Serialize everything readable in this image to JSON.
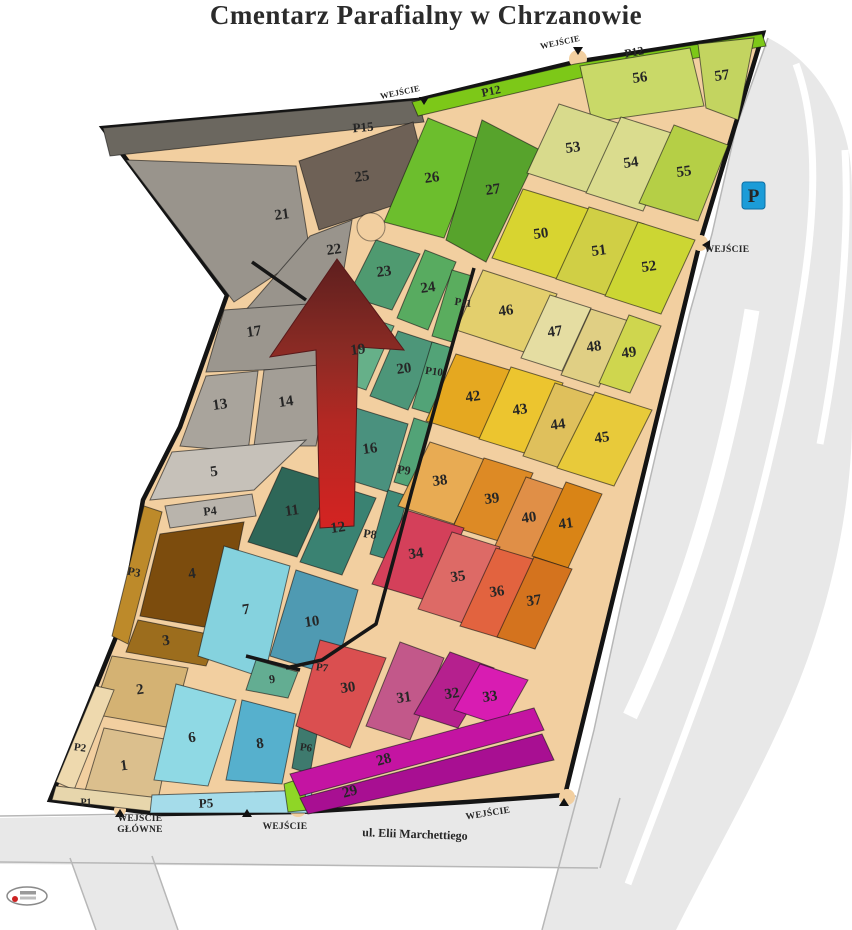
{
  "title": "Cmentarz Parafialny w Chrzanowie",
  "map": {
    "base_fill": "#f2cfa0",
    "outline_stroke": "#141414",
    "outline": "103,128 418,100 575,62 763,33 700,242 565,795 467,802 300,812 160,814 50,800 120,627 143,500 180,427 227,295",
    "roads": {
      "fill": "#e8e8e8",
      "edge": "#b7b7b7",
      "fills": [
        "M768,38 C802,54 830,88 842,126 C851,152 852,172 852,200 L852,418 C852,520 824,632 780,726 C748,796 708,866 676,930 L542,930 L560,862 L578,794 L594,730 L622,600 L660,436 L690,312 L712,234 L736,128 Z",
        "M0,818 L300,812 L467,802 L576,796 L620,798 L600,868 L0,864 Z",
        "M70,858 L152,856 L178,930 L96,930 Z"
      ],
      "stripes": [
        {
          "d": "M796,64 C820,130 816,220 798,320 C778,436 746,564 706,676 C684,738 658,804 628,884",
          "w": 7
        },
        {
          "d": "M845,150 C850,240 840,340 820,444",
          "w": 7
        },
        {
          "d": "M752,310 C736,406 714,498 684,584 C668,630 650,674 630,716",
          "w": 15
        }
      ],
      "edges": [
        "M0,816 L300,812 L467,802 L576,796",
        "M0,862 L598,868",
        "M542,930 L560,862 L578,794 L594,730 L622,600 L660,436 L690,312 L712,234 L736,128 L768,38",
        "M70,858 L96,930",
        "M152,856 L178,930",
        "M620,798 L600,868"
      ]
    },
    "sections": [
      {
        "label": "",
        "color": "#6b675f",
        "points": "103,128 418,100 424,122 110,156",
        "lx": 0,
        "ly": 0
      },
      {
        "label": "25",
        "color": "#6e6156",
        "points": "299,161 413,122 431,193 319,230",
        "lx": 362,
        "ly": 177
      },
      {
        "label": "21",
        "color": "#99948c",
        "points": "126,160 296,166 310,252 234,302",
        "lx": 282,
        "ly": 215
      },
      {
        "label": "22",
        "color": "#99948c",
        "points": "310,236 352,220 338,306 244,312",
        "lx": 334,
        "ly": 250
      },
      {
        "label": "17",
        "color": "#9b968e",
        "points": "224,310 336,302 318,368 206,372",
        "lx": 254,
        "ly": 332
      },
      {
        "label": "13",
        "color": "#a9a49c",
        "points": "206,376 258,371 248,452 180,446",
        "lx": 220,
        "ly": 405
      },
      {
        "label": "14",
        "color": "#a39e96",
        "points": "264,370 330,364 316,446 254,446",
        "lx": 286,
        "ly": 402
      },
      {
        "label": "5",
        "color": "#c6c1b9",
        "points": "172,452 306,440 254,490 150,500",
        "lx": 214,
        "ly": 472
      },
      {
        "label": "",
        "color": "#b9b4ac",
        "points": "165,506 252,494 256,516 170,528",
        "lx": 0,
        "ly": 0
      },
      {
        "label": "",
        "color": "#bd8a2a",
        "points": "144,506 162,512 128,644 112,636",
        "lx": 0,
        "ly": 0
      },
      {
        "label": "4",
        "color": "#7c4c0d",
        "points": "160,534 244,522 222,630 140,616",
        "lx": 192,
        "ly": 574
      },
      {
        "label": "3",
        "color": "#9c6d1d",
        "points": "138,620 218,636 206,666 126,652",
        "lx": 166,
        "ly": 641
      },
      {
        "label": "2",
        "color": "#d4b273",
        "points": "112,656 188,668 172,728 92,714",
        "lx": 140,
        "ly": 690
      },
      {
        "label": "1",
        "color": "#dbbf8d",
        "points": "104,728 170,740 158,800 84,794",
        "lx": 124,
        "ly": 766
      },
      {
        "label": "",
        "color": "#eed9ae",
        "points": "96,686 114,690 74,790 56,782",
        "lx": 0,
        "ly": 0
      },
      {
        "label": "",
        "color": "#e7d6ac",
        "points": "56,786 160,798 158,812 52,800",
        "lx": 0,
        "ly": 0
      },
      {
        "label": "7",
        "color": "#85d2de",
        "points": "224,546 290,566 264,678 198,656",
        "lx": 246,
        "ly": 610
      },
      {
        "label": "10",
        "color": "#4f9ab2",
        "points": "296,570 358,590 334,676 270,656",
        "lx": 312,
        "ly": 622
      },
      {
        "label": "9",
        "color": "#63ad92",
        "points": "256,660 298,672 288,698 246,690",
        "lx": 272,
        "ly": 679,
        "fs": 12
      },
      {
        "label": "6",
        "color": "#8fd9e4",
        "points": "176,684 236,700 208,786 154,780",
        "lx": 192,
        "ly": 738
      },
      {
        "label": "8",
        "color": "#56b0cd",
        "points": "242,700 296,714 282,784 226,780",
        "lx": 260,
        "ly": 744
      },
      {
        "label": "",
        "color": "#a5dcea",
        "points": "152,795 312,790 310,813 150,813",
        "lx": 0,
        "ly": 0
      },
      {
        "label": "",
        "color": "#3e7a6e",
        "points": "300,722 318,728 310,774 292,768",
        "lx": 0,
        "ly": 0
      },
      {
        "label": "",
        "color": "#8fd626",
        "points": "284,784 302,778 308,810 288,812",
        "lx": 0,
        "ly": 0
      },
      {
        "label": "11",
        "color": "#2e6758",
        "points": "282,467 331,482 297,557 248,542",
        "lx": 292,
        "ly": 511
      },
      {
        "label": "12",
        "color": "#3a8272",
        "points": "334,485 376,498 342,575 300,562",
        "lx": 338,
        "ly": 528
      },
      {
        "label": "16",
        "color": "#4a917e",
        "points": "356,408 408,424 388,492 330,474",
        "lx": 370,
        "ly": 449
      },
      {
        "label": "19",
        "color": "#66b089",
        "points": "352,312 394,326 366,390 326,376",
        "lx": 358,
        "ly": 350
      },
      {
        "label": "20",
        "color": "#4d9679",
        "points": "398,331 438,344 408,410 370,396",
        "lx": 404,
        "ly": 369
      },
      {
        "label": "23",
        "color": "#4f9a70",
        "points": "376,240 420,254 392,310 348,296",
        "lx": 384,
        "ly": 272
      },
      {
        "label": "24",
        "color": "#58ab60",
        "points": "425,250 456,262 428,330 397,318",
        "lx": 428,
        "ly": 288
      },
      {
        "label": "",
        "color": "#5aad5e",
        "points": "452,270 472,276 452,342 432,336",
        "lx": 0,
        "ly": 0
      },
      {
        "label": "",
        "color": "#52a377",
        "points": "432,342 452,348 432,414 412,408",
        "lx": 0,
        "ly": 0
      },
      {
        "label": "",
        "color": "#52a377",
        "points": "414,418 432,424 414,488 394,482",
        "lx": 0,
        "ly": 0
      },
      {
        "label": "",
        "color": "#3f8a78",
        "points": "388,490 408,496 390,560 370,554",
        "lx": 0,
        "ly": 0
      },
      {
        "label": "26",
        "color": "#6cbe2d",
        "points": "428,118 482,140 444,238 384,222",
        "lx": 432,
        "ly": 178
      },
      {
        "label": "27",
        "color": "#57a32c",
        "points": "482,120 540,150 486,262 446,240",
        "lx": 493,
        "ly": 190
      },
      {
        "label": "",
        "color": "#7dc818",
        "points": "412,102 575,64 762,34 766,46 580,78 418,116",
        "lx": 0,
        "ly": 0
      },
      {
        "label": "56",
        "color": "#c9d968",
        "points": "580,66 690,48 704,106 592,122",
        "lx": 640,
        "ly": 78
      },
      {
        "label": "57",
        "color": "#c3d460",
        "points": "698,44 754,38 738,120 706,108",
        "lx": 722,
        "ly": 76
      },
      {
        "label": "53",
        "color": "#d8da8c",
        "points": "559,104 621,124 589,193 527,173",
        "lx": 573,
        "ly": 148
      },
      {
        "label": "54",
        "color": "#dadc8e",
        "points": "621,117 678,135 643,211 586,193",
        "lx": 631,
        "ly": 163
      },
      {
        "label": "55",
        "color": "#b5cf46",
        "points": "674,125 728,145 698,221 639,203",
        "lx": 684,
        "ly": 172
      },
      {
        "label": "50",
        "color": "#d8d430",
        "points": "523,189 592,210 561,280 492,258",
        "lx": 541,
        "ly": 234
      },
      {
        "label": "51",
        "color": "#d0cf45",
        "points": "589,207 644,224 611,297 556,279",
        "lx": 599,
        "ly": 251
      },
      {
        "label": "52",
        "color": "#ccd633",
        "points": "638,222 695,240 661,314 605,296",
        "lx": 649,
        "ly": 267
      },
      {
        "label": "46",
        "color": "#e3cf6d",
        "points": "483,270 557,294 530,354 456,330",
        "lx": 506,
        "ly": 311
      },
      {
        "label": "47",
        "color": "#e5dda2",
        "points": "550,295 591,308 562,371 521,358",
        "lx": 555,
        "ly": 332
      },
      {
        "label": "48",
        "color": "#e0cf84",
        "points": "591,309 629,321 599,387 561,375",
        "lx": 594,
        "ly": 347
      },
      {
        "label": "49",
        "color": "#cfd64e",
        "points": "629,315 661,326 630,393 599,383",
        "lx": 629,
        "ly": 353
      },
      {
        "label": "42",
        "color": "#e5a820",
        "points": "456,354 523,374 492,442 426,421",
        "lx": 473,
        "ly": 397
      },
      {
        "label": "43",
        "color": "#ecc52f",
        "points": "511,367 563,383 531,455 479,439",
        "lx": 520,
        "ly": 410
      },
      {
        "label": "44",
        "color": "#dfc05c",
        "points": "555,383 595,396 563,469 523,456",
        "lx": 558,
        "ly": 425
      },
      {
        "label": "45",
        "color": "#e8ca3a",
        "points": "595,392 652,410 614,486 557,468",
        "lx": 602,
        "ly": 438
      },
      {
        "label": "38",
        "color": "#e8ab53",
        "points": "430,442 486,460 454,524 398,506",
        "lx": 440,
        "ly": 481
      },
      {
        "label": "39",
        "color": "#dd8a25",
        "points": "484,458 533,473 502,542 453,527",
        "lx": 492,
        "ly": 499
      },
      {
        "label": "40",
        "color": "#e08f47",
        "points": "526,477 566,490 534,561 494,548",
        "lx": 529,
        "ly": 518
      },
      {
        "label": "41",
        "color": "#d98416",
        "points": "566,482 602,494 568,568 532,556",
        "lx": 566,
        "ly": 524
      },
      {
        "label": "34",
        "color": "#d4405a",
        "points": "406,510 464,528 432,602 372,584",
        "lx": 416,
        "ly": 554
      },
      {
        "label": "35",
        "color": "#dd6a66",
        "points": "452,532 500,547 466,624 418,609",
        "lx": 458,
        "ly": 577
      },
      {
        "label": "36",
        "color": "#e2633f",
        "points": "496,548 536,560 500,638 460,626",
        "lx": 497,
        "ly": 592
      },
      {
        "label": "37",
        "color": "#d4731e",
        "points": "534,557 572,569 535,649 497,637",
        "lx": 534,
        "ly": 601
      },
      {
        "label": "30",
        "color": "#da4f50",
        "points": "320,640 386,658 350,748 296,726",
        "lx": 348,
        "ly": 688
      },
      {
        "label": "31",
        "color": "#c2588a",
        "points": "400,642 444,658 410,740 366,726",
        "lx": 404,
        "ly": 698
      },
      {
        "label": "32",
        "color": "#b5208e",
        "points": "450,652 494,668 458,728 414,714",
        "lx": 452,
        "ly": 694
      },
      {
        "label": "33",
        "color": "#d81cb2",
        "points": "480,664 528,680 502,726 454,710",
        "lx": 490,
        "ly": 697
      },
      {
        "label": "28",
        "color": "#c414a2",
        "points": "290,774 534,708 544,730 300,796",
        "lx": 384,
        "ly": 760,
        "rot": -15
      },
      {
        "label": "29",
        "color": "#a80f92",
        "points": "300,798 542,734 554,760 308,814",
        "lx": 350,
        "ly": 792,
        "rot": -15
      }
    ],
    "black_lines": [
      "474,268 452,346 432,418 412,490 394,558 376,624 322,660 286,668",
      "252,262 306,300",
      "246,656 300,670"
    ],
    "circle": {
      "cx": 371,
      "cy": 227,
      "r": 14
    },
    "bulges": [
      [
        423,
        111,
        10
      ],
      [
        578,
        59,
        9
      ],
      [
        700,
        243,
        8
      ],
      [
        567,
        797,
        8
      ],
      [
        298,
        808,
        9
      ],
      [
        120,
        810,
        6
      ]
    ],
    "arrow": {
      "points": "337,259 404,350 358,347 354,526 320,528 316,350 270,357",
      "y1": 259,
      "y2": 528,
      "stops": [
        [
          "0",
          "#5e1f1e"
        ],
        [
          "0.35",
          "#8c2b24"
        ],
        [
          "0.6",
          "#b22823"
        ],
        [
          "1",
          "#d42322"
        ]
      ]
    },
    "path_labels": [
      {
        "label": "P1",
        "x": 86,
        "y": 803,
        "fs": 10,
        "rot": 0
      },
      {
        "label": "P2",
        "x": 80,
        "y": 748,
        "fs": 11,
        "rot": 8
      },
      {
        "label": "P3",
        "x": 134,
        "y": 572,
        "fs": 12,
        "rot": 12
      },
      {
        "label": "P4",
        "x": 210,
        "y": 511,
        "fs": 12,
        "rot": -6
      },
      {
        "label": "P5",
        "x": 206,
        "y": 803,
        "fs": 13,
        "rot": -2
      },
      {
        "label": "P6",
        "x": 306,
        "y": 748,
        "fs": 11,
        "rot": 8
      },
      {
        "label": "P7",
        "x": 322,
        "y": 668,
        "fs": 11,
        "rot": 8
      },
      {
        "label": "P8",
        "x": 370,
        "y": 534,
        "fs": 12,
        "rot": 8
      },
      {
        "label": "P9",
        "x": 404,
        "y": 470,
        "fs": 12,
        "rot": 8
      },
      {
        "label": "P10",
        "x": 434,
        "y": 372,
        "fs": 11,
        "rot": 8
      },
      {
        "label": "P11",
        "x": 463,
        "y": 303,
        "fs": 11,
        "rot": 8
      },
      {
        "label": "P12",
        "x": 491,
        "y": 91,
        "fs": 12,
        "rot": -12
      },
      {
        "label": "P12",
        "x": 634,
        "y": 52,
        "fs": 12,
        "rot": -11
      },
      {
        "label": "P15",
        "x": 363,
        "y": 127,
        "fs": 13,
        "rot": -5
      }
    ],
    "entrances": [
      {
        "lines": [
          "WEJŚCIE"
        ],
        "x": 400,
        "y": 92,
        "rot": -12,
        "marker": [
          424,
          104
        ],
        "dir": "down",
        "fs": 8.5
      },
      {
        "lines": [
          "WEJŚCIE"
        ],
        "x": 560,
        "y": 42,
        "rot": -12,
        "marker": [
          578,
          54
        ],
        "dir": "down",
        "fs": 8.5
      },
      {
        "lines": [
          "WEJŚCIE"
        ],
        "x": 727,
        "y": 250,
        "rot": 0,
        "marker": [
          703,
          245
        ],
        "dir": "left",
        "fs": 9.5
      },
      {
        "lines": [
          "WEJŚCIE",
          "GŁÓWNE"
        ],
        "x": 140,
        "y": 824,
        "rot": 0,
        "marker": [
          120,
          810
        ],
        "dir": "up",
        "fs": 9.5
      },
      {
        "lines": [
          "WEJŚCIE"
        ],
        "x": 285,
        "y": 827,
        "rot": 0,
        "marker": [
          247,
          810
        ],
        "dir": "up",
        "fs": 9.5
      },
      {
        "lines": [
          "WEJŚCIE"
        ],
        "x": 488,
        "y": 814,
        "rot": -9,
        "marker": [
          564,
          799
        ],
        "dir": "up",
        "fs": 9.5
      }
    ],
    "street": {
      "label": "ul. Elii Marchettiego",
      "x": 415,
      "y": 834,
      "rot": 2,
      "fs": 12
    },
    "parking": {
      "label": "P",
      "x": 742,
      "y": 182,
      "w": 23,
      "h": 27,
      "color": "#1b9cd8"
    }
  }
}
